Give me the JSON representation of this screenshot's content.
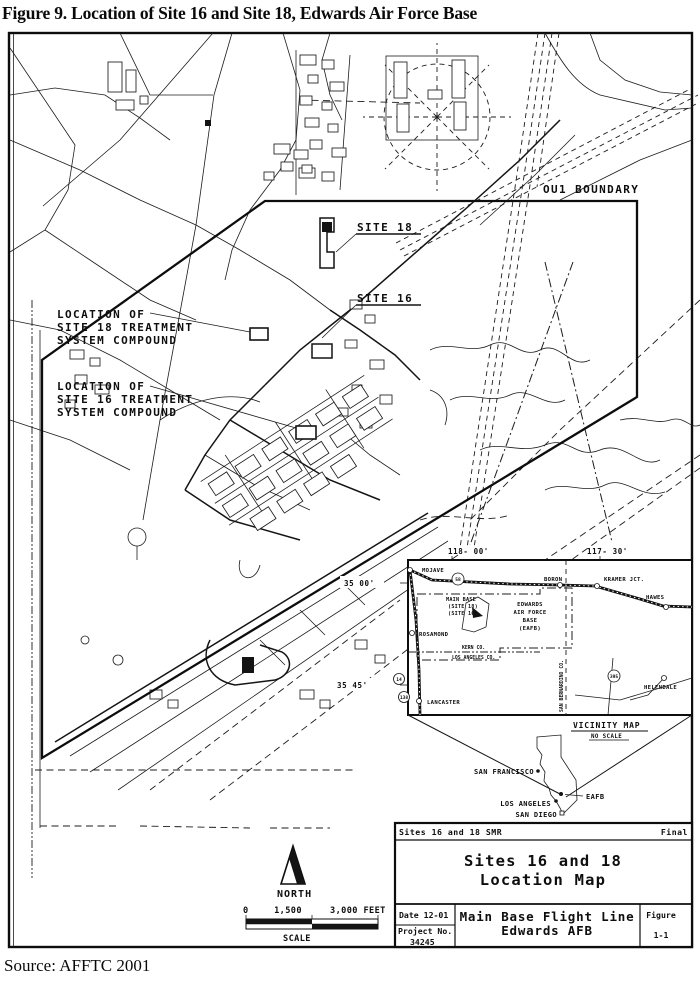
{
  "figure": {
    "title": "Figure 9. Location of Site 16 and Site 18, Edwards Air Force Base",
    "source": "Source: AFFTC 2001"
  },
  "map_labels": {
    "ou1": "OU1 BOUNDARY",
    "site18": "SITE 18",
    "site16": "SITE 16",
    "loc18": [
      "LOCATION OF",
      "SITE 18 TREATMENT",
      "SYSTEM COMPOUND"
    ],
    "loc16": [
      "LOCATION OF",
      "SITE 16 TREATMENT",
      "SYSTEM COMPOUND"
    ],
    "north": "NORTH",
    "scale": {
      "t0": "0",
      "t1": "1,500",
      "t2": "3,000 FEET",
      "label": "SCALE"
    }
  },
  "inset": {
    "lon_w": "118- 00'",
    "lon_e": "117- 30'",
    "lat_n": "35 00'",
    "lat_s": "35 45'",
    "mojave": "MOJAVE",
    "boron": "BORON",
    "kramer": "KRAMER JCT.",
    "hawes": "HAWES",
    "rosamond": "ROSAMOND",
    "lancaster": "LANCASTER",
    "helendale": "HELENDALE",
    "main_base": [
      "MAIN BASE",
      "(SITE 18)",
      "(SITE 16)"
    ],
    "eafb_block": [
      "EDWARDS",
      "AIR FORCE",
      "BASE",
      "(EAFB)"
    ],
    "kern": "KERN CO.",
    "los_angeles_co": "LOS ANGELES CO.",
    "san_bernardino": "SAN BERNARDINO CO.",
    "hwy58": "58",
    "hwy14": "14",
    "hwy138": "138",
    "hwy395": "395",
    "caption": "VICINITY MAP",
    "no_scale": "NO SCALE"
  },
  "california": {
    "sf": "SAN FRANCISCO",
    "eafb": "EAFB",
    "la": "LOS ANGELES",
    "sd": "SAN DIEGO"
  },
  "title_block": {
    "doc_left": "Sites 16 and 18 SMR",
    "doc_right": "Final",
    "title1": "Sites 16 and 18",
    "title2": "Location Map",
    "date": "Date 12-01",
    "project_label": "Project No.",
    "project_no": "34245",
    "subject1": "Main Base Flight Line",
    "subject2": "Edwards AFB",
    "figure_label": "Figure",
    "figure_no": "1-1"
  }
}
